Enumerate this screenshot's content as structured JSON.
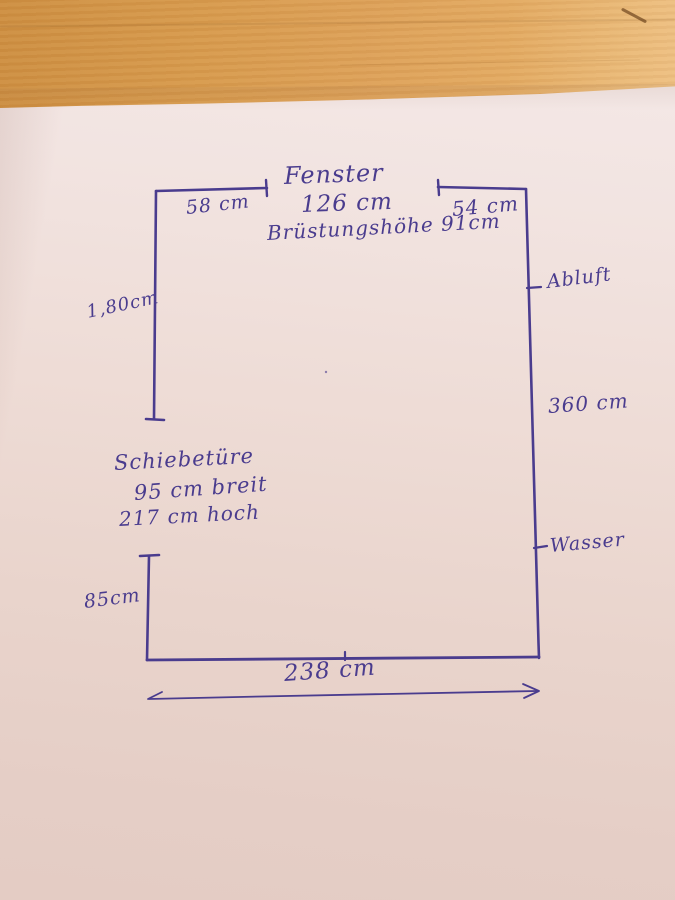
{
  "colors": {
    "ink": "#4a3c8e",
    "paper_top": "#f5eae9",
    "paper_bottom": "#e4ccc4",
    "wood": "#d99e53"
  },
  "sketch": {
    "window_label": "Fenster",
    "window_width": "126 cm",
    "parapet_height": "Brüstungshöhe 91cm",
    "top_left_wall": "58 cm",
    "top_right_wall": "54 cm",
    "left_upper_wall": "1,80cm",
    "right_wall": "360 cm",
    "exhaust_label": "Abluft",
    "water_label": "Wasser",
    "door_label": "Schiebetüre",
    "door_width": "95 cm breit",
    "door_height": "217 cm hoch",
    "left_lower_wall": "85cm",
    "bottom_wall": "238 cm"
  }
}
